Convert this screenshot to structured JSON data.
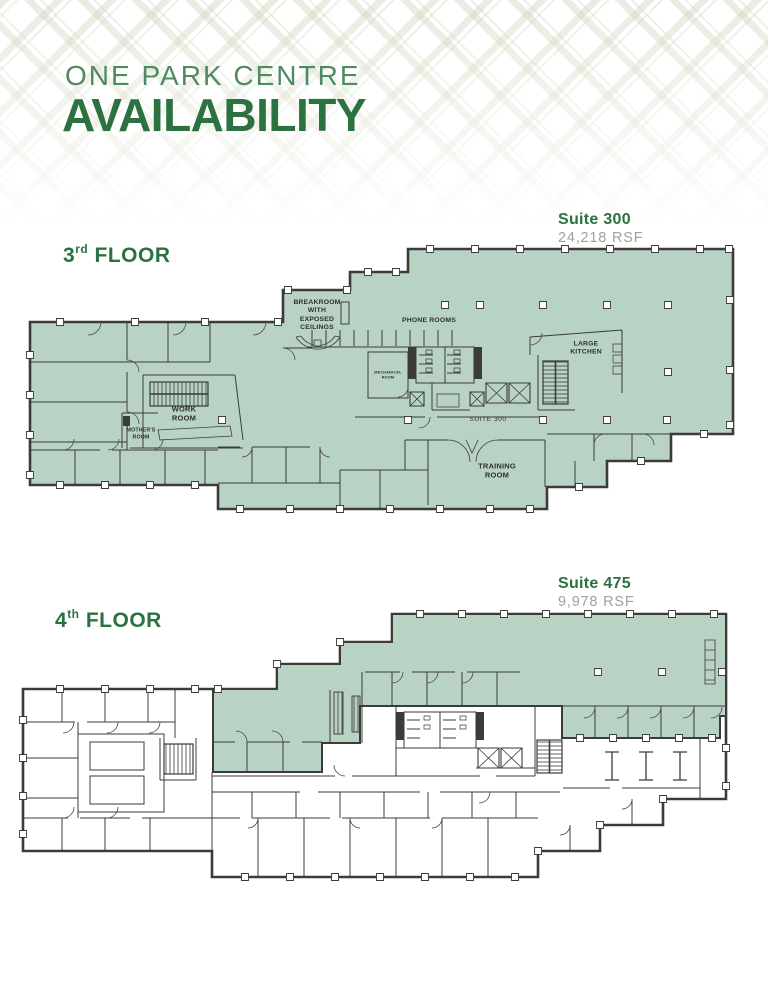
{
  "header": {
    "brand": "ONE PARK CENTRE",
    "title": "AVAILABILITY"
  },
  "floor3": {
    "floor_number": "3",
    "floor_ordinal": "rd",
    "floor_word": "FLOOR",
    "suite_label": "Suite 300",
    "rsf": "24,218 RSF",
    "plan_labels": {
      "breakroom": "BREAKROOM\nWITH\nEXPOSED\nCEILINGS",
      "phone_rooms": "PHONE ROOMS",
      "large_kitchen": "LARGE\nKITCHEN",
      "work_room": "WORK\nROOM",
      "mothers_room": "MOTHER'S\nROOM",
      "mechanical": "MECHANICAL\nROOM",
      "suite_tag": "SUITE 300",
      "training_room": "TRAINING\nROOM"
    }
  },
  "floor4": {
    "floor_number": "4",
    "floor_ordinal": "th",
    "floor_word": "FLOOR",
    "suite_label": "Suite 475",
    "rsf": "9,978 RSF"
  },
  "colors": {
    "accent_green": "#2c7140",
    "brand_green": "#4f8b60",
    "plan_fill": "#b8d2c4",
    "wall": "#3b3b3a",
    "rsf_gray": "#a0a29a"
  }
}
